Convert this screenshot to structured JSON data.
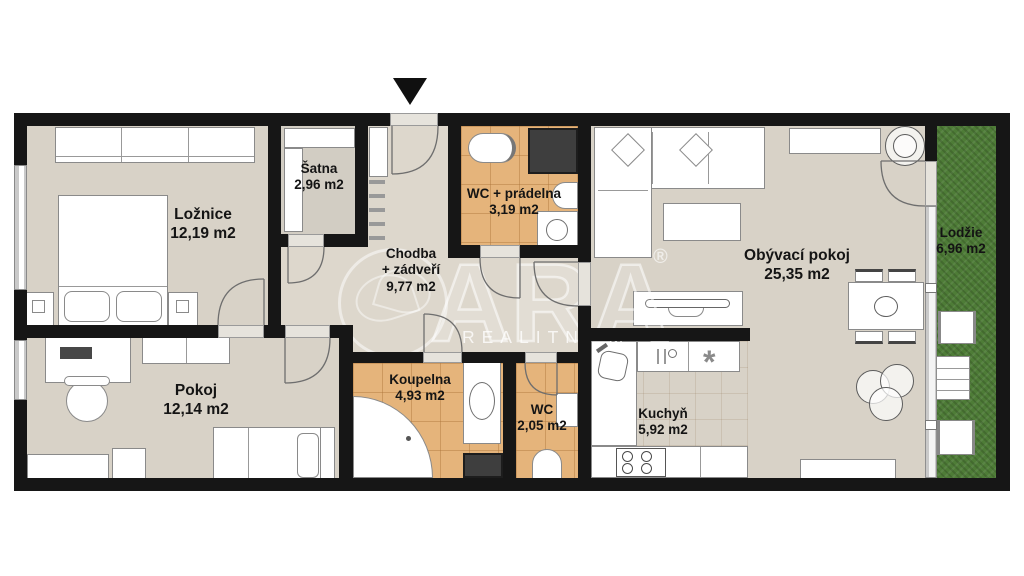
{
  "watermark": {
    "brand": "ARA",
    "registered": "®",
    "subtitle": "REALITNÍ M"
  },
  "rooms": {
    "loznice": {
      "name": "Ložnice",
      "area": "12,19 m2"
    },
    "satna": {
      "name": "Šatna",
      "area": "2,96 m2"
    },
    "chodba": {
      "name": "Chodba",
      "name2": "+ zádveří",
      "area": "9,77 m2"
    },
    "wc_pradelna": {
      "name": "WC + prádelna",
      "area": "3,19 m2"
    },
    "obyvaci_pokoj": {
      "name": "Obývací pokoj",
      "area": "25,35 m2"
    },
    "lodzie": {
      "name": "Lodžie",
      "area": "6,96 m2"
    },
    "pokoj": {
      "name": "Pokoj",
      "area": "12,14 m2"
    },
    "koupelna": {
      "name": "Koupelna",
      "area": "4,93 m2"
    },
    "wc": {
      "name": "WC",
      "area": "2,05 m2"
    },
    "kuchyn": {
      "name": "Kuchyň",
      "area": "5,92 m2"
    }
  },
  "icons": {
    "fan_glyph": "*"
  },
  "colors": {
    "wall": "#161616",
    "floor": "#d8d2c7",
    "hall_floor": "#ddd7cc",
    "tile": "#e5b47b",
    "balcony_grass": "#4e7c37",
    "shaft": "#3e3e3e",
    "watermark": "rgba(255,255,255,0.6)"
  }
}
